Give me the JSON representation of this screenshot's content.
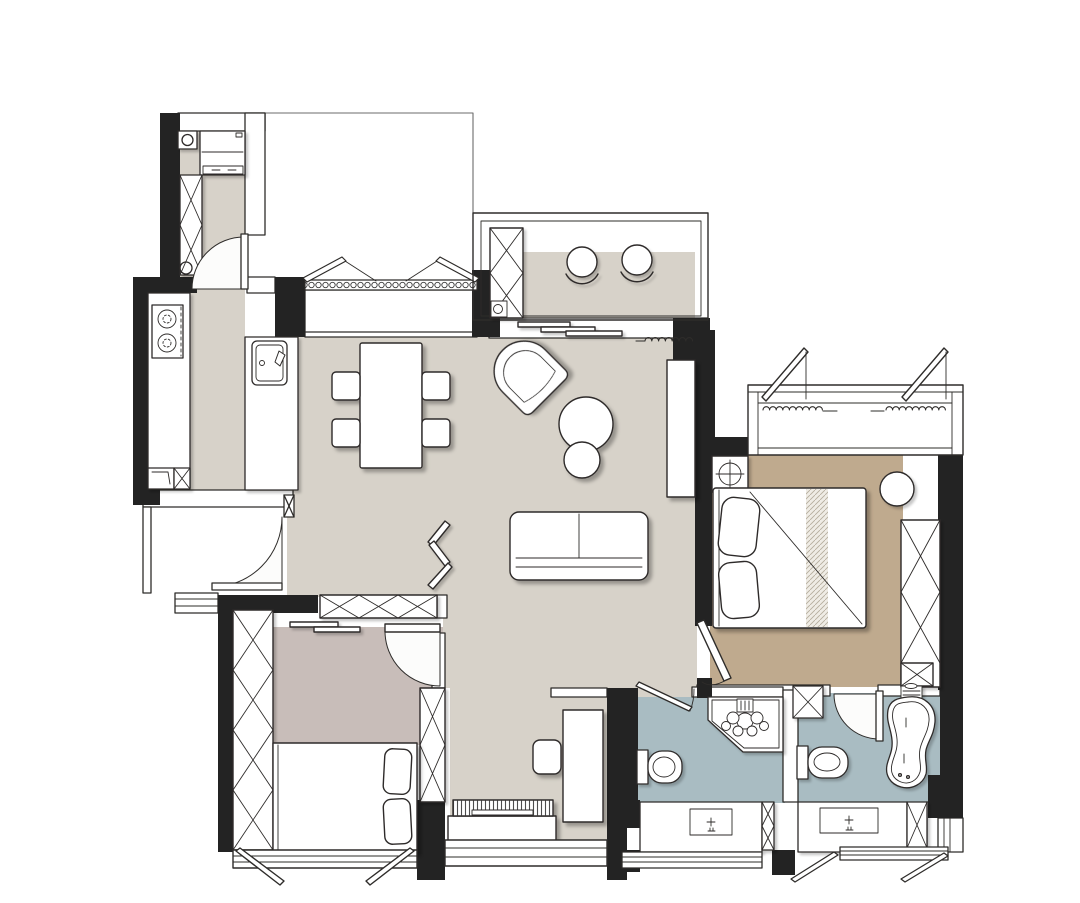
{
  "title": "apartment-floor-plan",
  "colors": {
    "background": "#ffffff",
    "wall": "#232323",
    "line": "#2e2c2a",
    "line_soft": "#6b6b6b",
    "floor_main": "#d7d2c9",
    "floor_master_bedroom": "#bfaa8e",
    "floor_second_bedroom": "#c8bdb9",
    "floor_bathroom": "#a9bcc2",
    "fixture_fill": "#ffffff",
    "swing_fill": "#fcfcfb",
    "hatch": "#6f6f6f"
  },
  "rooms": [
    {
      "id": "utility-entry",
      "floor_color": "floor_main"
    },
    {
      "id": "kitchen",
      "floor_color": "floor_main"
    },
    {
      "id": "living-dining",
      "floor_color": "floor_main"
    },
    {
      "id": "balcony",
      "floor_color": "floor_main"
    },
    {
      "id": "study-nook",
      "floor_color": "floor_main"
    },
    {
      "id": "master-bedroom",
      "floor_color": "floor_master_bedroom"
    },
    {
      "id": "second-bedroom",
      "floor_color": "floor_second_bedroom"
    },
    {
      "id": "bathroom-left",
      "floor_color": "floor_bathroom"
    },
    {
      "id": "bathroom-right",
      "floor_color": "floor_bathroom"
    }
  ],
  "fixtures": [
    "refrigerator",
    "water-heater",
    "hall-cabinet",
    "gas-stove",
    "kitchen-counter",
    "kitchen-sink",
    "dining-table",
    "dining-chair",
    "lounge-chair",
    "side-table",
    "sofa",
    "folding-screen",
    "tv-wall-panel",
    "balcony-cabinet",
    "balcony-chair",
    "sliding-door",
    "curtain",
    "insect-screen-window",
    "double-bed",
    "bed-runner",
    "pillow",
    "nightstand",
    "bedside-table",
    "wardrobe",
    "duct-shaft",
    "single-bed",
    "desk",
    "desk-chair",
    "tv-console",
    "television",
    "toilet",
    "corner-shower",
    "bathtub",
    "tub-faucet",
    "vanity-counter",
    "wash-basin",
    "swing-door",
    "casement-window",
    "window-sill",
    "entry-threshold"
  ]
}
